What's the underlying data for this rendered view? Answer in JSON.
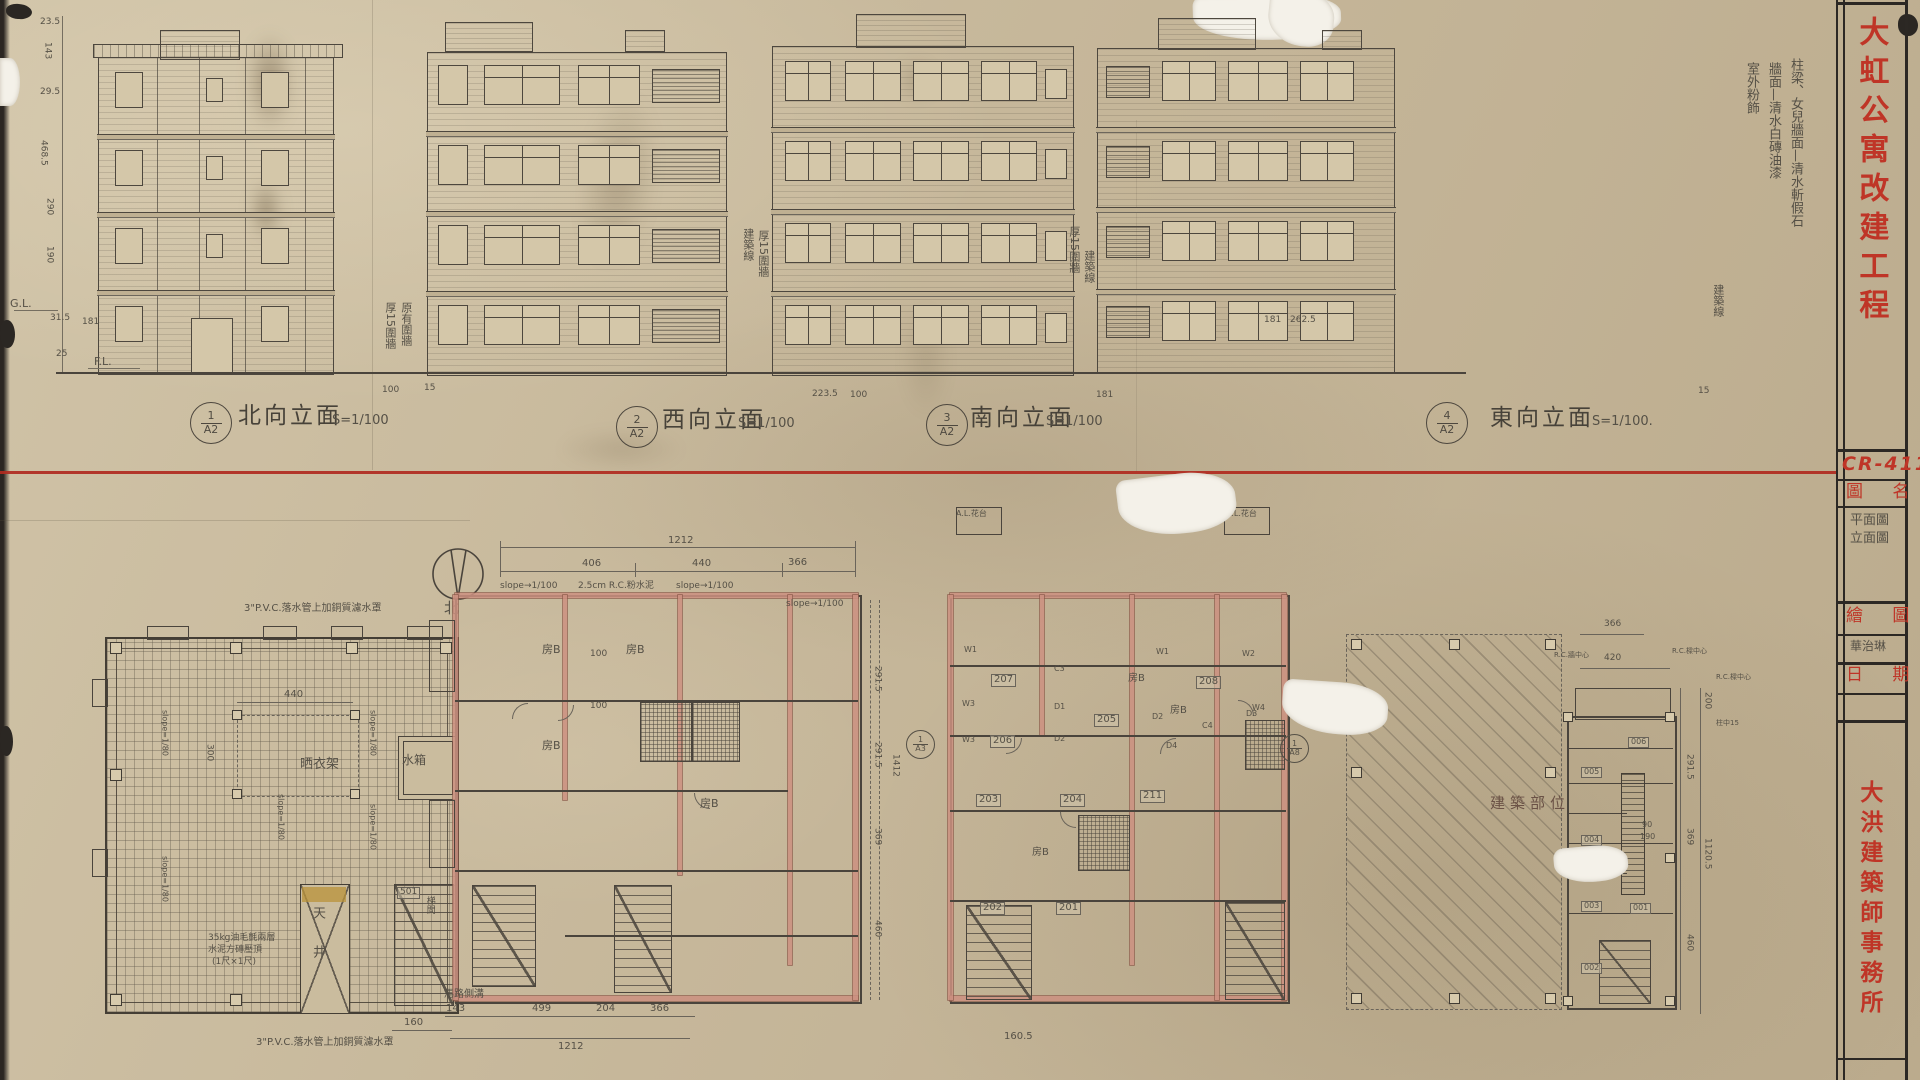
{
  "colors": {
    "stamp_red": "#bf3527",
    "divider_red": "#b02a20",
    "wall_pink": "#cd9181",
    "paper": "#c7b89c",
    "pencil": "#555046",
    "ink": "#4a443c"
  },
  "titleblock": {
    "project": "大虹公寓改建工程",
    "no": "CR-411",
    "name_label": "圖 名",
    "name1": "平面圖",
    "name2": "立面圖",
    "draw_label": "繪 圖",
    "drafter": "華治琳",
    "date_label": "日 期",
    "firm": "大洪建築師事務所"
  },
  "notes": {
    "finish1": "柱梁、女兒牆面—清水斬假石",
    "finish2": "牆面—清水白磚油漆",
    "finish3": "室外粉飾",
    "bldg_line": "建築線",
    "wall15": "厚15圍牆",
    "wall_orig": "原有圍牆"
  },
  "elev": {
    "e1": {
      "n": "1",
      "s": "A2",
      "t": "北向立面",
      "sc": "S=1/100"
    },
    "e2": {
      "n": "2",
      "s": "A2",
      "t": "西向立面",
      "sc": "S=1/100"
    },
    "e3": {
      "n": "3",
      "s": "A2",
      "t": "南向立面",
      "sc": "S=1/100"
    },
    "e4": {
      "n": "4",
      "s": "A2",
      "t": "東向立面",
      "sc": "S=1/100."
    }
  },
  "lvl": {
    "gl": "G.L.",
    "fl": "F.L."
  },
  "ldim": [
    "23.5",
    "143",
    "29.5",
    "468.5",
    "290",
    "190",
    "31.5",
    "25"
  ],
  "gdim": [
    "181",
    "100",
    "15",
    "223.5",
    "100",
    "181",
    "181",
    "262.5",
    "15"
  ],
  "north": "北",
  "roof": {
    "pvc": "3\"P.V.C.落水管上加銅質濾水罩",
    "slope": "slope=1/80",
    "c440": "440",
    "c300": "300",
    "rack": "晒衣架",
    "tank": "水箱",
    "well": "天井",
    "stair_no": "501",
    "stair": "梯間",
    "cap1": "35kg油毛氈兩層",
    "cap2": "水泥方磚壓頂",
    "cap3": "(1尺×1尺)",
    "d160": "160"
  },
  "p2": {
    "total": "1212",
    "seg": [
      "406",
      "440",
      "366"
    ],
    "top_notes": [
      "slope→1/100",
      "2.5cm R.C.粉水泥",
      "slope→1/100"
    ],
    "room": "房B",
    "d100": "100",
    "right": [
      "291.5",
      "291.5",
      "369",
      "460"
    ],
    "rtotal": "1412",
    "bottom": [
      "143",
      "499",
      "204",
      "366"
    ],
    "btotal": "1212",
    "gutter": "馬路側溝"
  },
  "p3": {
    "rooms": [
      "207",
      "208",
      "206",
      "205",
      "203",
      "204",
      "211",
      "202",
      "201"
    ],
    "win": [
      "W1",
      "W2",
      "W3",
      "W4"
    ],
    "door": [
      "D1",
      "D2",
      "D3",
      "D4"
    ],
    "clo": [
      "C3",
      "C4"
    ],
    "room": "房B",
    "planter": "A.L.花台",
    "d1605": "160.5",
    "refA3": {
      "n": "1",
      "s": "A3"
    },
    "refA8": {
      "n": "1",
      "s": "A8"
    }
  },
  "site": {
    "label": "建築部位"
  },
  "np": {
    "rooms": [
      "006",
      "005",
      "004",
      "003",
      "001",
      "002"
    ],
    "right": [
      "200",
      "291.5",
      "369",
      "460"
    ],
    "total": "1120.5",
    "d90": "90",
    "d190": "190",
    "d366": "366",
    "d420": "420",
    "wall_c": "R.C.牆中心",
    "beam_c": "R.C.樑中心",
    "col_c": "柱中15"
  }
}
